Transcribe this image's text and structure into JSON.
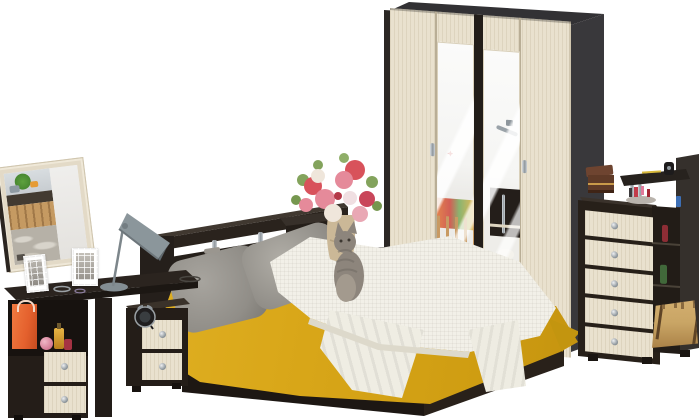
{
  "canvas": {
    "width": 700,
    "height": 420
  },
  "scene": {
    "type": "product-photo",
    "subject": "bedroom-furniture-set",
    "items": [
      {
        "name": "vanity-mirror",
        "finish": "oak-frame"
      },
      {
        "name": "desk-lamp",
        "color_key": "lamp"
      },
      {
        "name": "vanity-desk",
        "finish": "wenge-oak",
        "drawers": 2,
        "props": [
          "gift-bag",
          "perfume-bottles",
          "photo-frames",
          "bracelets"
        ]
      },
      {
        "name": "nightstand",
        "finish": "wenge-oak",
        "drawers": 2,
        "props": [
          "alarm-clock"
        ]
      },
      {
        "name": "bed",
        "finish": "wenge-oak",
        "props": [
          "headboard-shelf",
          "chrome-posts",
          "gray-pillows",
          "leopard-pillow",
          "yellow-bedspread",
          "white-throw",
          "cat",
          "remote"
        ]
      },
      {
        "name": "flower-pedestal",
        "finish": "wenge",
        "props": [
          "vase-bouquet"
        ]
      },
      {
        "name": "wardrobe",
        "finish": "wenge-oak",
        "doors": 4,
        "mirror_doors": 2,
        "props": [
          "door-handles"
        ]
      },
      {
        "name": "chest-of-drawers",
        "finish": "wenge-oak",
        "drawers": 5,
        "props": [
          "jewelry-box",
          "cosmetics",
          "top-shelf",
          "perfume-shelf-bottles",
          "straw-bag"
        ]
      }
    ]
  },
  "palette": {
    "bg": "#ffffff",
    "wenge": "#251f1b",
    "wenge_top": "#3a322b",
    "wenge_deep": "#17120f",
    "side_gray": "#39383b",
    "top_gray": "#323134",
    "oak": "#e9e1ce",
    "oak_shadow": "#c9bfa7",
    "yellow": "#d9a719",
    "yellow_dark": "#b8880c",
    "throw": "#f2f0e8",
    "throw_shadow": "#ddd9cb",
    "pillow": "#918e88",
    "pillow_light": "#a7a49e",
    "sheet": "#f7f5ef",
    "mirror": "#f1f0ee",
    "orange": "#e4602d",
    "straw": "#c9a565",
    "lamp": "#8b969b",
    "wood_box": "#5f3a27",
    "flower_red": "#d8525b",
    "flower_pink": "#e58a9a",
    "leaf": "#83a35c",
    "cat_gray": "#8d857c"
  }
}
